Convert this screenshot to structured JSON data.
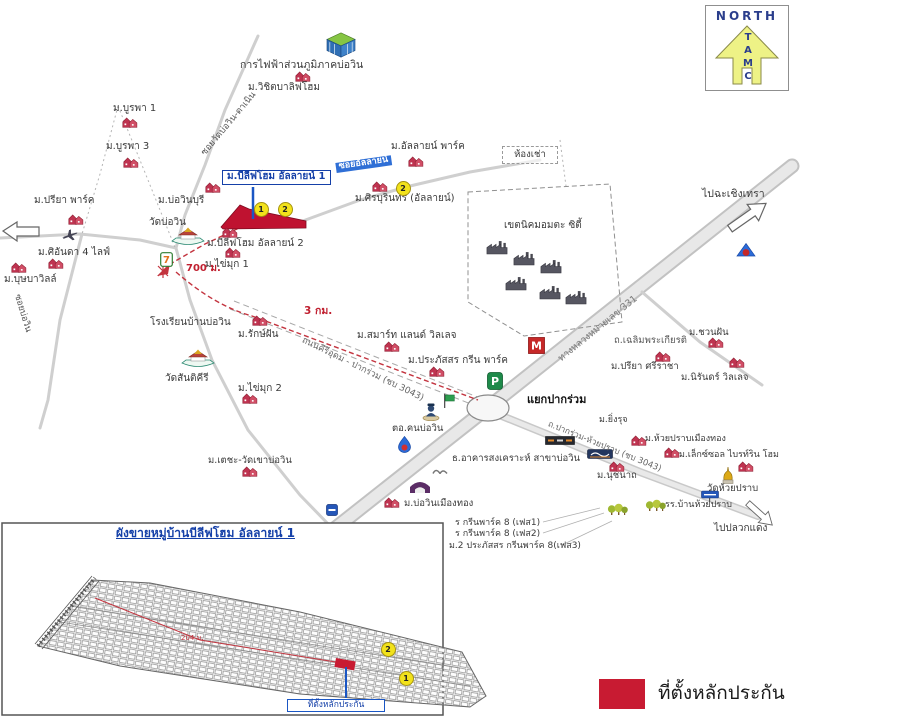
{
  "compass": {
    "north": "NORTH",
    "letters_stacked": "T\nA\nM\nC"
  },
  "legend": {
    "label": "ที่ตั้งหลักประกัน",
    "swatch_color": "#c81b32"
  },
  "colors": {
    "subject_red": "#bf1230",
    "legend_red": "#c81b32",
    "label_blue": "#1540a8",
    "road_gray": "#d9d9d9",
    "badge_yellow": "#f2e21b",
    "route_red": "#c3343f"
  },
  "map": {
    "labels": [
      {
        "text": "การไฟฟ้าส่วนภูมิภาคบ่อวิน",
        "x": 240,
        "y": 60,
        "size": 10.5
      },
      {
        "text": "ม.วิชิตบาลิฟโฮม",
        "x": 248,
        "y": 83
      },
      {
        "text": "ม.บูรพา 1",
        "x": 113,
        "y": 104
      },
      {
        "text": "ม.บูรพา 3",
        "x": 106,
        "y": 142
      },
      {
        "text": "ซอยวัดบ่อวิน-ตาเนิน",
        "x": 204,
        "y": 150,
        "rot": -50,
        "size": 9,
        "color": "#555555",
        "name": "road-label"
      },
      {
        "text": "ม.บีลีฟโฮม อัลลายน์ 1",
        "x": 222,
        "y": 170,
        "bold": 1,
        "size": 10,
        "color": "#1540a8",
        "border": "#1540a8",
        "name": "subject-label-box"
      },
      {
        "text": "ม.บ่อวินบุรี",
        "x": 158,
        "y": 196
      },
      {
        "text": "วัดบ่อวิน",
        "x": 149,
        "y": 218
      },
      {
        "text": "ม.บีลีฟโฮม อัลลายน์ 2",
        "x": 207,
        "y": 239
      },
      {
        "text": "ม.ไข่มุก 1",
        "x": 205,
        "y": 260
      },
      {
        "text": "700 ม.",
        "x": 186,
        "y": 264,
        "bold": 1,
        "size": 10,
        "color": "#c02030",
        "name": "distance-label"
      },
      {
        "text": "ซอยอัลลายน์",
        "x": 336,
        "y": 163,
        "size": 9,
        "bold": 1,
        "color": "#ffffff",
        "bg": "#2f6fd6",
        "rot": -8,
        "name": "road-label"
      },
      {
        "text": "ม.อัลลายน์ พาร์ค",
        "x": 391,
        "y": 142
      },
      {
        "text": "ห้องเช่า",
        "x": 502,
        "y": 146,
        "w": 54,
        "size": 9.5,
        "cls": "dashed-box",
        "name": "rental-rooms-box"
      },
      {
        "text": "ม.ศิรบุรินทร์ (อัลลายน์)",
        "x": 355,
        "y": 194
      },
      {
        "text": "เขตนิคมอมตะ ซิตี้",
        "x": 504,
        "y": 221
      },
      {
        "text": "ไปฉะเชิงเทรา",
        "x": 702,
        "y": 189,
        "size": 10.5,
        "name": "direction-label"
      },
      {
        "text": "ทางหลวงหมายเลข 331",
        "x": 560,
        "y": 355,
        "rot": -39,
        "size": 9.5,
        "color": "#777777",
        "name": "road-label"
      },
      {
        "text": "3 กม.",
        "x": 304,
        "y": 306,
        "bold": 1,
        "size": 10.5,
        "color": "#c02030",
        "name": "distance-label"
      },
      {
        "text": "ม.รักษ์ฝัน",
        "x": 238,
        "y": 330
      },
      {
        "text": "โรงเรียนบ้านบ่อวิน",
        "x": 150,
        "y": 318
      },
      {
        "text": "วัดสันติคีรี",
        "x": 165,
        "y": 374
      },
      {
        "text": "ม.ไข่มุก 2",
        "x": 238,
        "y": 384
      },
      {
        "text": "ถนนคีรีอุดม - ปากร่วม (ชบ 3043)",
        "x": 302,
        "y": 336,
        "rot": 26,
        "size": 9,
        "color": "#666666",
        "name": "road-label"
      },
      {
        "text": "ม.สมาร์ท แลนด์ วิลเลจ",
        "x": 357,
        "y": 331
      },
      {
        "text": "ม.ประภัสสร กรีน พาร์ค",
        "x": 408,
        "y": 356
      },
      {
        "text": "แยกปากร่วม",
        "x": 527,
        "y": 394,
        "bold": 1,
        "size": 11,
        "color": "#111111",
        "name": "junction-label"
      },
      {
        "text": "ถ.ปากร่วม-ห้วยปราบ (ชบ 3043)",
        "x": 548,
        "y": 420,
        "rot": 22,
        "size": 8.5,
        "color": "#666666",
        "name": "road-label"
      },
      {
        "text": "ธ.อาคารสงเคราะห์ สาขาบ่อวิน",
        "x": 452,
        "y": 454,
        "size": 9.5
      },
      {
        "text": "ม.นุชนาถ",
        "x": 597,
        "y": 471,
        "size": 9.5
      },
      {
        "text": "ตอ.คนบ่อวิน",
        "x": 392,
        "y": 424,
        "size": 9.5
      },
      {
        "text": "ม.บ่อวินเมืองทอง",
        "x": 404,
        "y": 499,
        "size": 9.5
      },
      {
        "text": "ม.ชวนฝัน",
        "x": 689,
        "y": 328,
        "size": 9.5
      },
      {
        "text": "ถ.เฉลิมพระเกียรติ",
        "x": 614,
        "y": 336,
        "size": 9.5,
        "color": "#555555",
        "name": "road-label"
      },
      {
        "text": "ม.ปรียา ศรีราชา",
        "x": 611,
        "y": 362,
        "size": 9.5
      },
      {
        "text": "ม.นิรันดร์ วิลเลจ",
        "x": 681,
        "y": 373,
        "size": 9.5
      },
      {
        "text": "ม.ยิ่งรุจ",
        "x": 599,
        "y": 416,
        "size": 9
      },
      {
        "text": "ม.ห้วยปราบเมืองทอง",
        "x": 645,
        "y": 435,
        "size": 9
      },
      {
        "text": "ม.เล็กซ์ซอล ไบรท์ริน โฮม",
        "x": 679,
        "y": 451,
        "size": 9
      },
      {
        "text": "วัดห้วยปราบ",
        "x": 707,
        "y": 484,
        "size": 9.5
      },
      {
        "text": "รร.บ้านห้วยปราบ",
        "x": 665,
        "y": 501,
        "size": 9
      },
      {
        "text": "ไปปลวกแดง",
        "x": 714,
        "y": 524,
        "size": 10,
        "name": "direction-label"
      },
      {
        "text": "ม.ปรียา พาร์ค",
        "x": 34,
        "y": 196
      },
      {
        "text": "ม.ศิอันดา 4 ไลฟ์",
        "x": 38,
        "y": 248
      },
      {
        "text": "ม.บุษบาวิลล์",
        "x": 4,
        "y": 275
      },
      {
        "text": "ซอยบ่อวิน",
        "x": 16,
        "y": 290,
        "rot": 73,
        "size": 9,
        "color": "#555555",
        "name": "road-label"
      },
      {
        "text": "ม.เตชะ-วัดเขาบ่อวิน",
        "x": 208,
        "y": 456,
        "size": 9.5
      },
      {
        "text": "ร กรีนพาร์ค 8 (เฟส1)",
        "x": 455,
        "y": 519,
        "size": 9
      },
      {
        "text": "ร กรีนพาร์ค 8 (เฟส2)",
        "x": 455,
        "y": 530,
        "size": 9
      },
      {
        "text": "ม.2 ประภัสสร กรีนพาร์ค 8(เฟส3)",
        "x": 449,
        "y": 542,
        "size": 9
      },
      {
        "text": "ผังขายหมู่บ้านบีลีฟโฮม อัลลายน์ 1",
        "x": 116,
        "y": 527,
        "size": 12,
        "bold": 1,
        "color": "#1540a8",
        "underline": 1,
        "name": "inset-title"
      },
      {
        "text": "204 ม.",
        "x": 181,
        "y": 635,
        "size": 7,
        "color": "#c0303a",
        "name": "distance-label"
      },
      {
        "text": "ที่ตั้งหลักประกัน",
        "x": 287,
        "y": 699,
        "w": 96,
        "size": 8.5,
        "color": "#1540a8",
        "border": "#1a56c4",
        "cls": "callout",
        "name": "inset-callout"
      }
    ],
    "badges": [
      {
        "n": "1",
        "x": 260,
        "y": 208
      },
      {
        "n": "2",
        "x": 284,
        "y": 208
      },
      {
        "n": "2",
        "x": 402,
        "y": 187
      },
      {
        "n": "2",
        "x": 387,
        "y": 648
      },
      {
        "n": "1",
        "x": 405,
        "y": 677
      }
    ],
    "markers": [
      {
        "icon": "pea",
        "x": 341,
        "y": 45
      },
      {
        "icon": "house",
        "x": 303,
        "y": 76
      },
      {
        "icon": "house",
        "x": 130,
        "y": 122
      },
      {
        "icon": "house",
        "x": 131,
        "y": 162
      },
      {
        "icon": "house",
        "x": 213,
        "y": 187
      },
      {
        "icon": "house",
        "x": 230,
        "y": 232
      },
      {
        "icon": "house",
        "x": 233,
        "y": 252
      },
      {
        "icon": "temple",
        "x": 188,
        "y": 237
      },
      {
        "icon": "seven",
        "x": 166,
        "y": 259
      },
      {
        "icon": "house",
        "x": 380,
        "y": 186
      },
      {
        "icon": "house",
        "x": 416,
        "y": 161
      },
      {
        "icon": "house",
        "x": 76,
        "y": 219
      },
      {
        "icon": "house",
        "x": 56,
        "y": 263
      },
      {
        "icon": "house",
        "x": 19,
        "y": 267
      },
      {
        "icon": "plane",
        "x": 70,
        "y": 235,
        "rot": -20
      },
      {
        "icon": "house",
        "x": 260,
        "y": 320
      },
      {
        "icon": "temple",
        "x": 198,
        "y": 359
      },
      {
        "icon": "house",
        "x": 250,
        "y": 398
      },
      {
        "icon": "house",
        "x": 250,
        "y": 471
      },
      {
        "icon": "house",
        "x": 392,
        "y": 346
      },
      {
        "icon": "house",
        "x": 437,
        "y": 371
      },
      {
        "icon": "pgreen",
        "x": 495,
        "y": 381
      },
      {
        "icon": "makro",
        "x": 536,
        "y": 345
      },
      {
        "icon": "factory",
        "x": 497,
        "y": 247
      },
      {
        "icon": "factory",
        "x": 524,
        "y": 258
      },
      {
        "icon": "factory",
        "x": 551,
        "y": 266
      },
      {
        "icon": "factory",
        "x": 516,
        "y": 283
      },
      {
        "icon": "factory",
        "x": 550,
        "y": 292
      },
      {
        "icon": "factory",
        "x": 576,
        "y": 297
      },
      {
        "icon": "shrine",
        "x": 746,
        "y": 250
      },
      {
        "icon": "police",
        "x": 431,
        "y": 411
      },
      {
        "icon": "flag",
        "x": 449,
        "y": 401
      },
      {
        "icon": "ptt",
        "x": 404,
        "y": 444
      },
      {
        "icon": "gray",
        "x": 440,
        "y": 470
      },
      {
        "icon": "arch",
        "x": 420,
        "y": 487
      },
      {
        "icon": "house",
        "x": 392,
        "y": 502
      },
      {
        "icon": "bluesign",
        "x": 332,
        "y": 510
      },
      {
        "icon": "marketsign",
        "x": 560,
        "y": 440
      },
      {
        "icon": "banksign",
        "x": 600,
        "y": 454
      },
      {
        "icon": "house",
        "x": 617,
        "y": 466
      },
      {
        "icon": "house",
        "x": 716,
        "y": 342
      },
      {
        "icon": "house",
        "x": 663,
        "y": 356
      },
      {
        "icon": "house",
        "x": 737,
        "y": 362
      },
      {
        "icon": "house",
        "x": 639,
        "y": 440
      },
      {
        "icon": "house",
        "x": 672,
        "y": 452
      },
      {
        "icon": "house",
        "x": 746,
        "y": 466
      },
      {
        "icon": "stupa",
        "x": 728,
        "y": 476
      },
      {
        "icon": "schoolsign",
        "x": 710,
        "y": 496
      },
      {
        "icon": "trees",
        "x": 656,
        "y": 505
      },
      {
        "icon": "trees",
        "x": 618,
        "y": 509
      }
    ]
  }
}
